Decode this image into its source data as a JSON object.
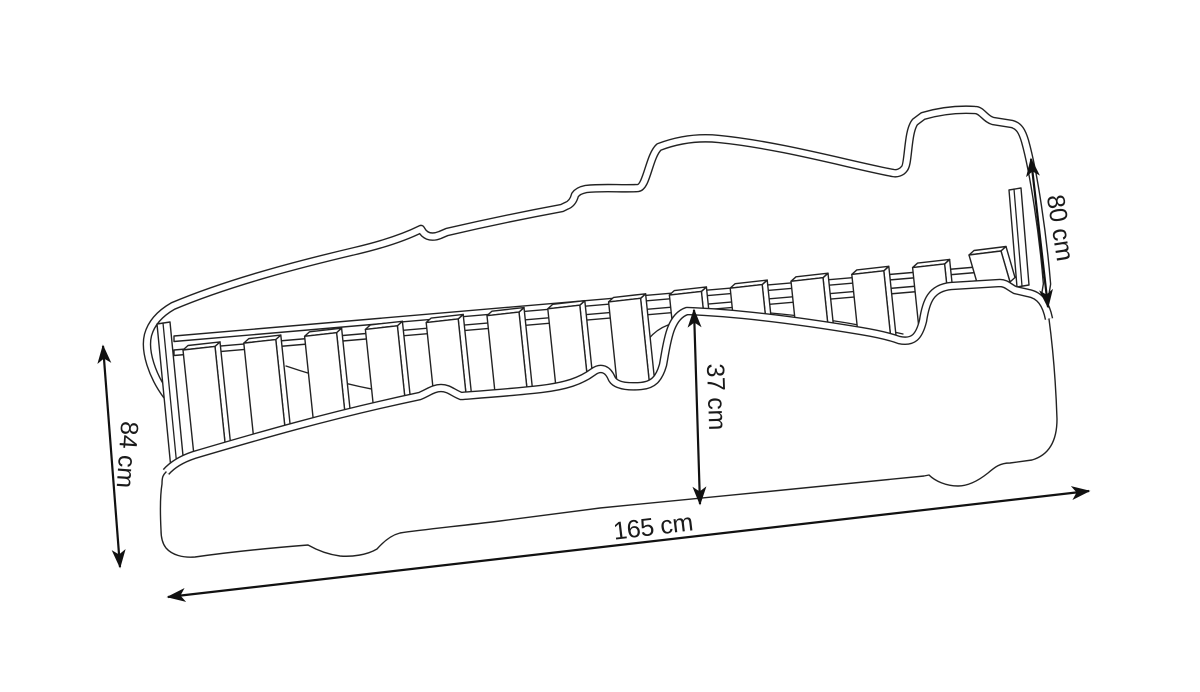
{
  "diagram": {
    "kind": "car-bed dimension drawing",
    "dimensions": {
      "length": "165 cm",
      "height": "84 cm",
      "front_height": "80 cm",
      "side_height": "37 cm"
    }
  },
  "colors": {
    "background": "#ffffff",
    "line": "#222222",
    "arrow": "#111111",
    "text": "#1a1a1a"
  }
}
